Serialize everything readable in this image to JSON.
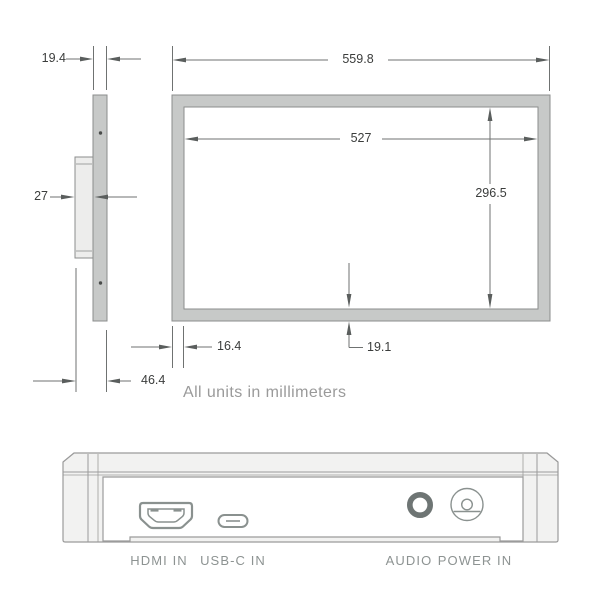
{
  "dimensions": {
    "panel_thickness": "19.4",
    "overall_width": "559.8",
    "active_width": "527",
    "active_height": "296.5",
    "mount_depth": "27",
    "side_bezel": "16.4",
    "bottom_bezel": "19.1",
    "total_depth": "46.4",
    "units_note": "All units in millimeters"
  },
  "ports": {
    "hdmi_label": "HDMI IN",
    "usbc_label": "USB-C IN",
    "audio_label": "AUDIO",
    "power_label": "POWER IN"
  },
  "colors": {
    "frame_fill": "#c7c9c8",
    "frame_stroke": "#8b8d8c",
    "dimension_line": "#6f7271",
    "dimension_text": "#3b3d3c",
    "muted_text": "#9a9a9a",
    "port_label_text": "#8d9392",
    "device_stroke": "#9b9b9b",
    "device_fill": "#f2f2f1"
  }
}
